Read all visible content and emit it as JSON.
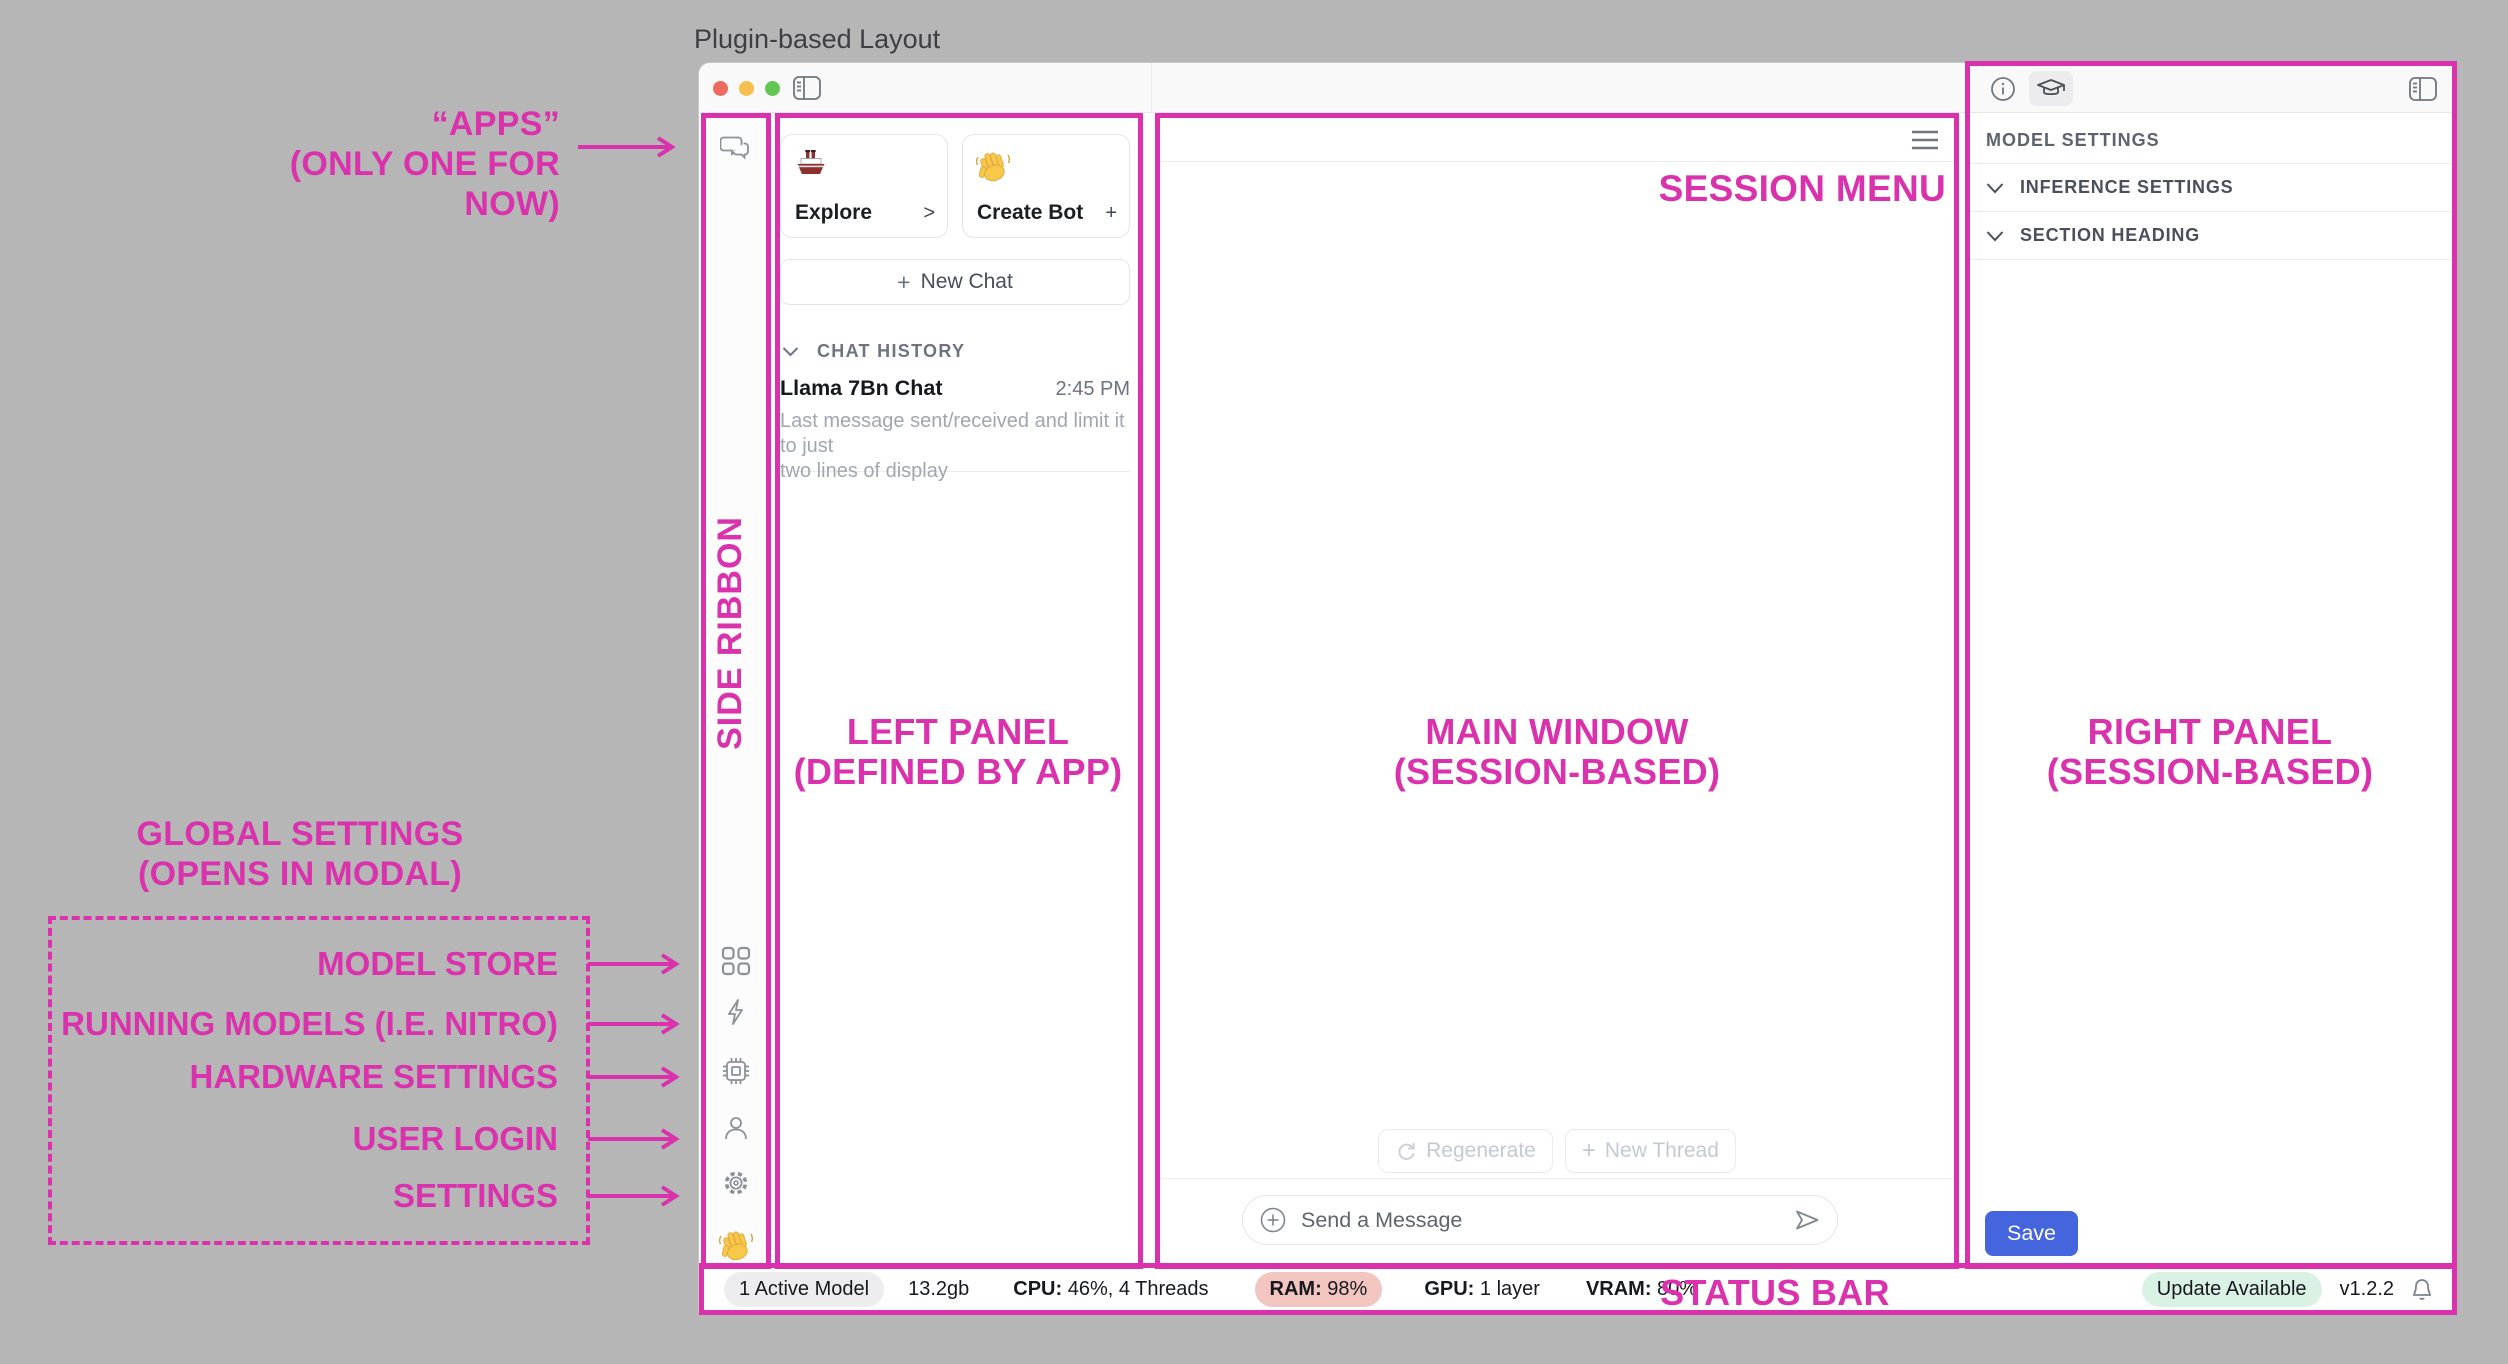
{
  "page": {
    "title": "Plugin-based Layout"
  },
  "colors": {
    "annotation_pink": "#DA31AC",
    "save_blue": "#4565DF",
    "ram_badge_bg": "#F2C5C1",
    "update_badge_bg": "#DAF2E3",
    "active_model_bg": "#EDEDF0",
    "traffic_red": "#EC6A5E",
    "traffic_yellow": "#F5BF4F",
    "traffic_green": "#62C655"
  },
  "annotations": {
    "apps_line1": "“APPS”",
    "apps_line2": "(ONLY ONE FOR NOW)",
    "side_ribbon": "SIDE RIBBON",
    "left_panel_line1": "LEFT PANEL",
    "left_panel_line2": "(DEFINED BY APP)",
    "main_window_line1": "MAIN WINDOW",
    "main_window_line2": "(SESSION-BASED)",
    "right_panel_line1": "RIGHT PANEL",
    "right_panel_line2": "(SESSION-BASED)",
    "session_menu": "SESSION MENU",
    "status_bar": "STATUS BAR",
    "global_settings_line1": "GLOBAL SETTINGS",
    "global_settings_line2": "(OPENS IN MODAL)",
    "global_items": [
      {
        "label": "MODEL STORE"
      },
      {
        "label": "RUNNING MODELS (I.E. NITRO)"
      },
      {
        "label": "HARDWARE SETTINGS"
      },
      {
        "label": "USER LOGIN"
      },
      {
        "label": "SETTINGS"
      }
    ]
  },
  "icons": {
    "ribbon_top": "chat-bubbles-icon",
    "ribbon_bottom": [
      "grid-apps-icon",
      "lightning-icon",
      "chip-icon",
      "user-icon",
      "gear-icon",
      "wave-hand-emoji"
    ],
    "titlebar": [
      "left-sidebar-toggle-icon",
      "info-icon",
      "graduation-cap-icon",
      "right-sidebar-toggle-icon"
    ],
    "main": [
      "hamburger-menu-icon",
      "refresh-icon",
      "plus-circle-icon",
      "send-icon"
    ],
    "status": [
      "bell-icon"
    ]
  },
  "left_panel": {
    "cards": [
      {
        "icon": "ship-emoji",
        "label": "Explore",
        "affordance": ">"
      },
      {
        "icon": "wave-hand-emoji",
        "label": "Create Bot",
        "affordance": "+"
      }
    ],
    "new_chat_plus": "+",
    "new_chat_label": "New Chat",
    "history_header": "CHAT HISTORY",
    "chat": {
      "title": "Llama 7Bn Chat",
      "time": "2:45 PM",
      "preview_line1": "Last message sent/received and limit it to just",
      "preview_line2": "two lines of display"
    }
  },
  "main_window": {
    "regenerate_label": "Regenerate",
    "new_thread_plus": "+",
    "new_thread_label": "New Thread",
    "composer_placeholder": "Send a Message"
  },
  "right_panel": {
    "heading": "MODEL SETTINGS",
    "sections": [
      {
        "label": "INFERENCE SETTINGS"
      },
      {
        "label": "SECTION HEADING"
      }
    ],
    "save_label": "Save"
  },
  "status_bar": {
    "active_model": "1 Active Model",
    "memory": "13.2gb",
    "cpu_label": "CPU:",
    "cpu_value": " 46%, 4 Threads",
    "ram_label": "RAM:",
    "ram_value": " 98%",
    "gpu_label": "GPU:",
    "gpu_value": " 1 layer",
    "vram_label": "VRAM:",
    "vram_value": " 80%",
    "update_badge": "Update Available",
    "version": "v1.2.2"
  }
}
